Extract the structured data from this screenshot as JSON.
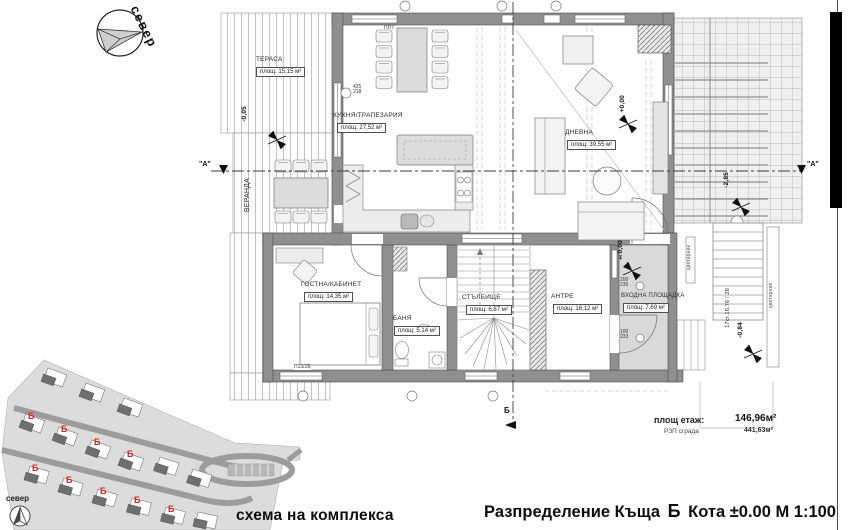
{
  "north_compass": {
    "label": "север"
  },
  "floor_plan": {
    "rooms": [
      {
        "name": "ТЕРАСА",
        "area": "площ: 15,15 м²"
      },
      {
        "name": "КУХНЯ/ТРАПЕЗАРИЯ",
        "area": "площ: 27,52 м²"
      },
      {
        "name": "ДНЕВНА",
        "area": "площ: 39,55 м²"
      },
      {
        "name": "ГОСТНА/КАБИНЕТ",
        "area": "площ: 14,35 м²"
      },
      {
        "name": "БАНЯ",
        "area": "площ: 5,14 м²"
      },
      {
        "name": "СТЪЛБИЩЕ",
        "area": "площ: 6,87 м²"
      },
      {
        "name": "АНТРЕ",
        "area": "площ: 16,12 м²"
      },
      {
        "name": "ВХОДНА ПЛОЩАДКА",
        "area": "площ: 7,69 м²"
      }
    ],
    "veranda_label": "ВЕРАНДА",
    "planter_label": "цветарник",
    "levels": {
      "terrace": "-0,05",
      "living": "+0,00",
      "entrance": "±0,00",
      "garden": "-2,85",
      "ext_stairs": "-0,84"
    },
    "stairs_note": "17ст.16,76 / 28",
    "section_a_label": "\"А\"",
    "section_b_label": "Б",
    "dims": {
      "d1_top": "425",
      "d1_bot": "218",
      "d2_top": "200",
      "d2_bot": "230",
      "d3_top": "100",
      "d3_bot": "233"
    },
    "window_tags": {
      "t1": "ПП7",
      "t2": "П13/2В"
    },
    "summary": {
      "floor_label": "площ етаж:",
      "floor_value": "146,96м²",
      "building_label": "РЗП сграда",
      "building_value": "441,63м²"
    }
  },
  "site_plan": {
    "caption": "схема на комплекса",
    "house_mark": "Б",
    "compass_label": "север"
  },
  "title_block": {
    "part1": "Разпределение Къща",
    "house_mark": "Б",
    "part2": "Кота ±0.00 М 1:100"
  }
}
